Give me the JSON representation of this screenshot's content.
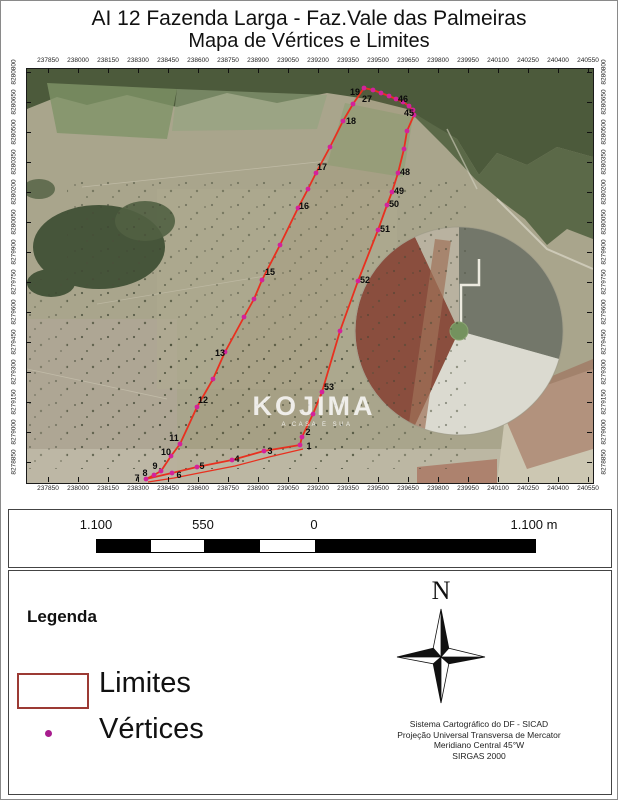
{
  "title": {
    "line1": "AI 12 Fazenda Larga - Faz.Vale das Palmeiras",
    "line2": "Mapa de Vértices e Limites"
  },
  "map": {
    "easting_labels": [
      "237850",
      "238000",
      "238150",
      "238300",
      "238450",
      "238600",
      "238750",
      "238900",
      "239050",
      "239200",
      "239350",
      "239500",
      "239650",
      "239800",
      "239950",
      "240100",
      "240250",
      "240400",
      "240550"
    ],
    "northing_labels": [
      "8280800",
      "8280650",
      "8280500",
      "8280350",
      "8280200",
      "8280050",
      "8279900",
      "8279750",
      "8279600",
      "8279450",
      "8279300",
      "8279150",
      "8279000",
      "8278850"
    ],
    "boundary_color": "#e8301f",
    "vertex_dot_color": "#d4219b",
    "outline": [
      [
        119,
        410
      ],
      [
        127,
        406
      ],
      [
        134,
        402
      ],
      [
        144,
        387
      ],
      [
        153,
        375
      ],
      [
        170,
        338
      ],
      [
        186,
        310
      ],
      [
        198,
        283
      ],
      [
        217,
        248
      ],
      [
        227,
        230
      ],
      [
        235,
        211
      ],
      [
        253,
        176
      ],
      [
        271,
        139
      ],
      [
        281,
        120
      ],
      [
        289,
        104
      ],
      [
        303,
        78
      ],
      [
        316,
        52
      ],
      [
        326,
        35
      ],
      [
        337,
        19
      ],
      [
        346,
        21
      ],
      [
        354,
        24
      ],
      [
        362,
        27
      ],
      [
        369,
        30
      ],
      [
        376,
        33
      ],
      [
        382,
        37
      ],
      [
        386,
        41
      ],
      [
        387,
        46
      ],
      [
        380,
        62
      ],
      [
        377,
        80
      ],
      [
        371,
        104
      ],
      [
        365,
        123
      ],
      [
        360,
        136
      ],
      [
        351,
        161
      ],
      [
        331,
        212
      ],
      [
        313,
        262
      ],
      [
        295,
        323
      ],
      [
        286,
        345
      ],
      [
        275,
        368
      ],
      [
        273,
        376
      ],
      [
        237,
        382
      ],
      [
        205,
        391
      ],
      [
        170,
        398
      ],
      [
        145,
        404
      ]
    ],
    "outline_inner": [
      [
        121,
        413
      ],
      [
        147,
        409
      ],
      [
        172,
        404
      ],
      [
        208,
        397
      ],
      [
        242,
        388
      ],
      [
        276,
        380
      ]
    ],
    "vertex_labels": [
      {
        "label": "19",
        "x": 328,
        "y": 26
      },
      {
        "label": "27",
        "x": 340,
        "y": 33
      },
      {
        "label": "46",
        "x": 376,
        "y": 33
      },
      {
        "label": "45",
        "x": 382,
        "y": 47
      },
      {
        "label": "18",
        "x": 324,
        "y": 55
      },
      {
        "label": "17",
        "x": 295,
        "y": 101
      },
      {
        "label": "16",
        "x": 277,
        "y": 140
      },
      {
        "label": "15",
        "x": 243,
        "y": 206
      },
      {
        "label": "13",
        "x": 193,
        "y": 287
      },
      {
        "label": "12",
        "x": 176,
        "y": 334
      },
      {
        "label": "11",
        "x": 147,
        "y": 372
      },
      {
        "label": "10",
        "x": 139,
        "y": 386
      },
      {
        "label": "9",
        "x": 128,
        "y": 400
      },
      {
        "label": "8",
        "x": 118,
        "y": 407
      },
      {
        "label": "7",
        "x": 110,
        "y": 412
      },
      {
        "label": "6",
        "x": 152,
        "y": 409
      },
      {
        "label": "5",
        "x": 175,
        "y": 400
      },
      {
        "label": "4",
        "x": 210,
        "y": 393
      },
      {
        "label": "3",
        "x": 243,
        "y": 385
      },
      {
        "label": "2",
        "x": 281,
        "y": 366
      },
      {
        "label": "1",
        "x": 282,
        "y": 380
      },
      {
        "label": "48",
        "x": 378,
        "y": 106
      },
      {
        "label": "49",
        "x": 372,
        "y": 125
      },
      {
        "label": "50",
        "x": 367,
        "y": 138
      },
      {
        "label": "51",
        "x": 358,
        "y": 163
      },
      {
        "label": "52",
        "x": 338,
        "y": 214
      },
      {
        "label": "53",
        "x": 302,
        "y": 321
      }
    ],
    "watermark": {
      "text": "KOJIMA",
      "subtext": "A CASA É SUA"
    }
  },
  "scalebar": {
    "labels": [
      {
        "text": "1.100",
        "x": 87
      },
      {
        "text": "550",
        "x": 194
      },
      {
        "text": "0",
        "x": 305
      },
      {
        "text": "1.100 m",
        "x": 525
      }
    ]
  },
  "legend": {
    "title": "Legenda",
    "items": [
      {
        "label": "Limites",
        "symbol": "rect-outline",
        "color": "#9c3a34"
      },
      {
        "label": "Vértices",
        "symbol": "dot",
        "color": "#a81c8e"
      }
    ]
  },
  "compass": {
    "label": "N"
  },
  "projection_lines": [
    "Sistema Cartográfico do DF - SICAD",
    "Projeção Universal Transversa de Mercator",
    "Meridiano Central 45°W",
    "SIRGAS 2000"
  ]
}
